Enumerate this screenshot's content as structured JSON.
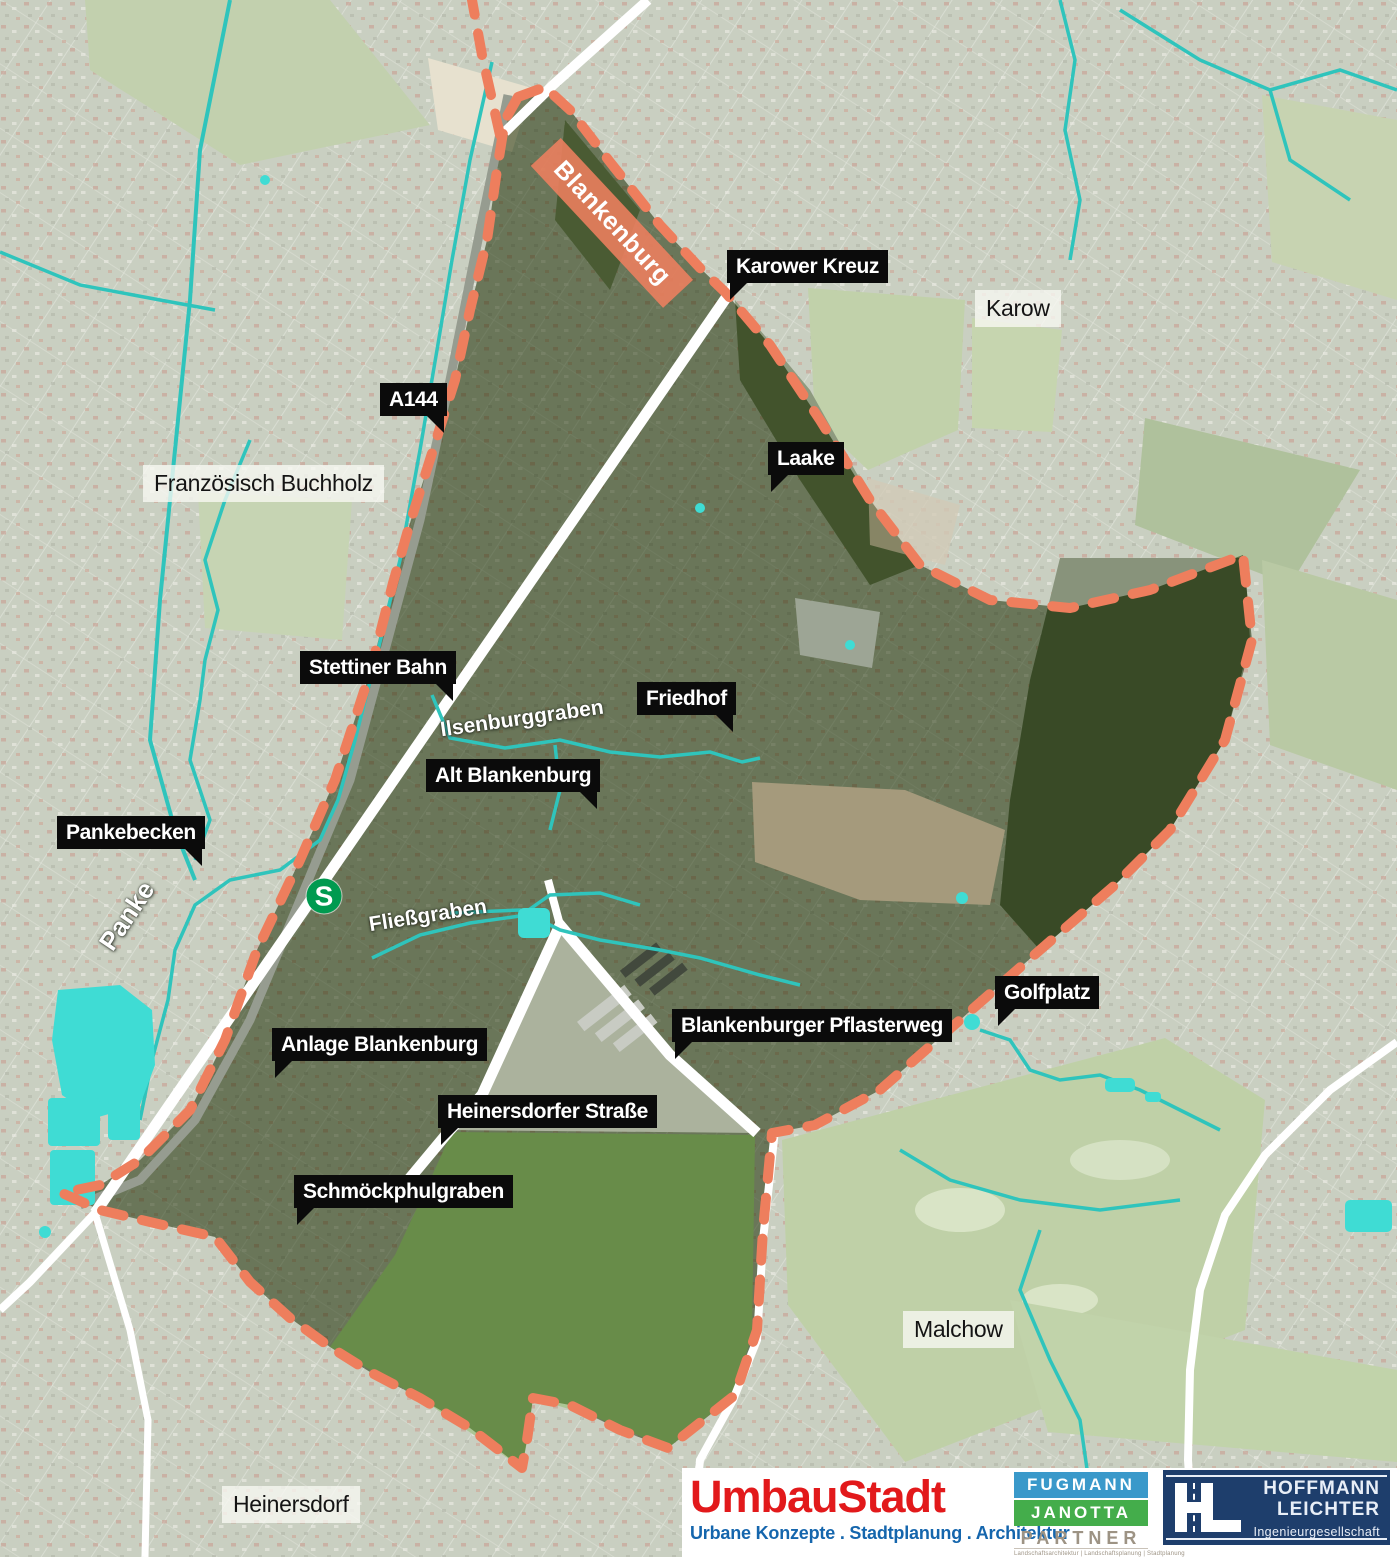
{
  "map": {
    "colors": {
      "boundary": "#EE7E5D",
      "water_line": "#2FC4BC",
      "water_fill": "#3FDCD4",
      "sbahn_green": "#009A50",
      "callout_bg": "#0B0B0B",
      "highlight_bg": "#EE7F5E"
    }
  },
  "labels": {
    "callouts_dark": [
      {
        "text": "Karower Kreuz",
        "x": 727,
        "y": 250,
        "tail": "bl"
      },
      {
        "text": "A144",
        "x": 380,
        "y": 383,
        "tail": "br"
      },
      {
        "text": "Laake",
        "x": 768,
        "y": 442,
        "tail": "bl"
      },
      {
        "text": "Stettiner Bahn",
        "x": 300,
        "y": 651,
        "tail": "br"
      },
      {
        "text": "Friedhof",
        "x": 637,
        "y": 682,
        "tail": "br"
      },
      {
        "text": "Alt Blankenburg",
        "x": 426,
        "y": 759,
        "tail": "br"
      },
      {
        "text": "Pankebecken",
        "x": 57,
        "y": 816,
        "tail": "br"
      },
      {
        "text": "Golfplatz",
        "x": 995,
        "y": 976,
        "tail": "bl"
      },
      {
        "text": "Blankenburger Pflasterweg",
        "x": 672,
        "y": 1009,
        "tail": "bl"
      },
      {
        "text": "Anlage Blankenburg",
        "x": 272,
        "y": 1028,
        "tail": "bl"
      },
      {
        "text": "Heinersdorfer Straße",
        "x": 438,
        "y": 1095,
        "tail": "bl"
      },
      {
        "text": "Schmöckphulgraben",
        "x": 294,
        "y": 1175,
        "tail": "bl"
      }
    ],
    "areas_light": [
      {
        "text": "Karow",
        "x": 975,
        "y": 290
      },
      {
        "text": "Französisch Buchholz",
        "x": 143,
        "y": 465
      },
      {
        "text": "Malchow",
        "x": 903,
        "y": 1311
      },
      {
        "text": "Heinersdorf",
        "x": 222,
        "y": 1486
      }
    ],
    "water": [
      {
        "text": "Ilsenburggraben",
        "cx": 522,
        "cy": 719,
        "rot": -8,
        "size": 21
      },
      {
        "text": "Fließgraben",
        "cx": 428,
        "cy": 916,
        "rot": -9,
        "size": 21
      },
      {
        "text": "Panke",
        "cx": 127,
        "cy": 916,
        "rot": -56,
        "size": 26
      }
    ],
    "highlight": {
      "text": "Blankenburg",
      "cx": 612,
      "cy": 223,
      "rot": 47
    },
    "sbahn": {
      "letter": "S",
      "cx": 324,
      "cy": 896
    }
  },
  "footer": {
    "umbaustadt": {
      "name": "UmbauStadt",
      "name_color": "#E2191B",
      "tagline": "Urbane Konzepte . Stadtplanung . Architektur",
      "tagline_color": "#1566AD"
    },
    "fugmann": {
      "line1": "FUGMANN",
      "line1_bg": "#3A99CA",
      "line2": "JANOTTA",
      "line2_bg": "#44AD4B",
      "line3": "PARTNER",
      "tagline": "Landschaftsarchitektur | Landschaftsplanung | Stadtplanung"
    },
    "hoffmann": {
      "bg": "#1E3E6C",
      "line1": "HOFFMANN",
      "line2": "LEICHTER",
      "line3": "Ingenieurgesellschaft"
    }
  }
}
